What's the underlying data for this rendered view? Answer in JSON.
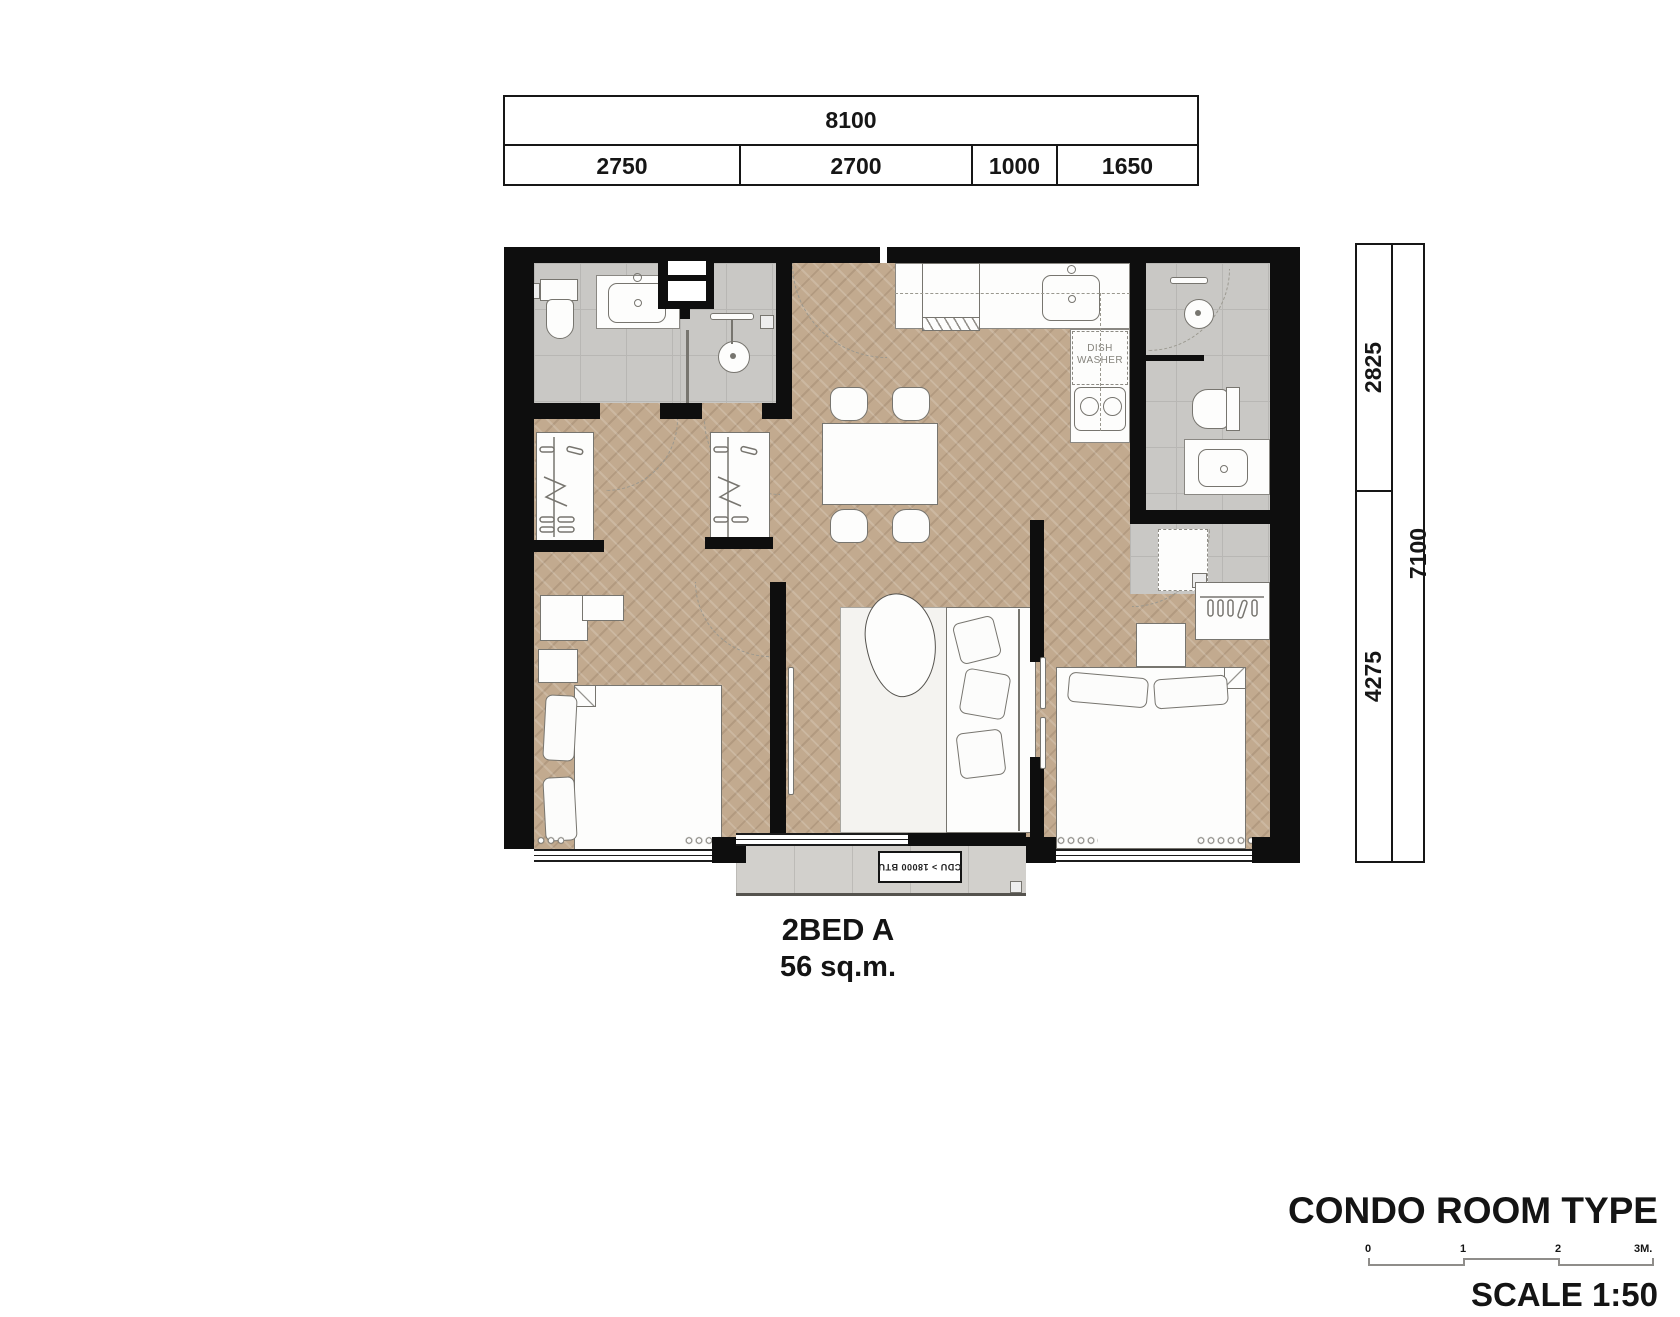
{
  "top_dimension_table": {
    "total": "8100",
    "segments": [
      "2750",
      "2700",
      "1000",
      "1650"
    ]
  },
  "right_dimension_table": {
    "total": "7100",
    "segments": [
      "2825",
      "4275"
    ]
  },
  "plan_labels": {
    "dishwasher_line1": "DISH",
    "dishwasher_line2": "WASHER",
    "cdu_unit": "CDU > 18000 BTU"
  },
  "unit": {
    "name": "2BED A",
    "area": "56 sq.m."
  },
  "footer": {
    "title": "CONDO ROOM TYPE",
    "scale_label": "SCALE 1:50",
    "scale_bar_ticks": [
      "0",
      "1",
      "2",
      "3M."
    ]
  },
  "colors": {
    "wall": "#0e0e0e",
    "wood_floor": "#c2aa8f",
    "tile_floor": "#c9c8c5",
    "balcony_floor": "#d2d0cc",
    "outline": "#77756f",
    "text": "#141414"
  }
}
